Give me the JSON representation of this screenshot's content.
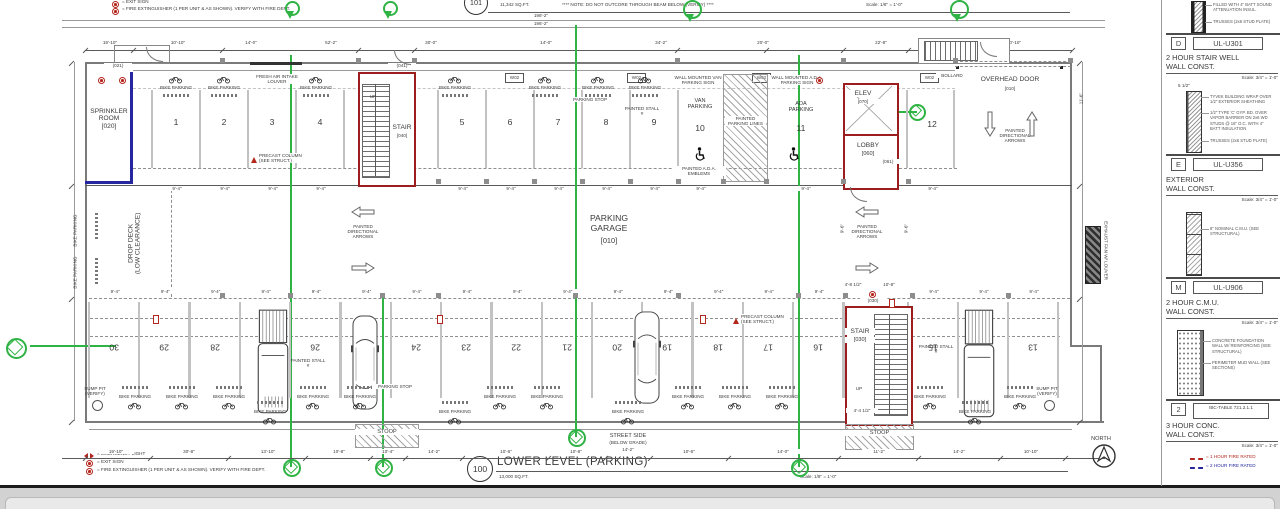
{
  "colors": {
    "green": "#2fb344",
    "red_wall": "#9b1d1d",
    "blue_wall": "#26269e",
    "legend_red": "#b3271e",
    "legend_blue": "#26269e"
  },
  "legend_top": {
    "exit": "= EXIT SIGN",
    "extinguisher": "= FIRE EXTINGUISHER (1 PER UNIT & AS SHOWN). VERIFY WITH FIRE DEPT."
  },
  "legend_bottom": {
    "emergency": "= EMERGENCY LIGHT",
    "exit": "= EXIT SIGN",
    "extinguisher": "= FIRE EXTINGUISHER (1 PER UNIT & AS SHOWN). VERIFY WITH FIRE DEPT."
  },
  "legend_fire": {
    "one_hour": "= 1 HOUR FIRE RATED",
    "two_hour": "= 2 HOUR FIRE RATED"
  },
  "titles": {
    "upper": {
      "number": "101",
      "sqft": "11,342 SQ.FT.",
      "note": "**** NOTE: DO NOT OUTCORE THROUGH BEAM BELOW (VERIFY) ****",
      "scale": "Scale: 1/8\" = 1'-0\""
    },
    "lower": {
      "number": "100",
      "name": "LOWER LEVEL (PARKING)",
      "sqft": "13,000 SQ.FT.",
      "scale": "Scale: 1/8\" = 1'-0\""
    }
  },
  "compass": {
    "north": "NORTH"
  },
  "rooms": {
    "sprinkler": {
      "name": "SPRINKLER ROOM",
      "tag": "[020]"
    },
    "stair_top": {
      "name": "STAIR",
      "tag": "[040]"
    },
    "stair_bottom": {
      "name": "STAIR",
      "tag": "[030]"
    },
    "elevator": {
      "name": "ELEV",
      "tag": "[070]"
    },
    "lobby": {
      "name": "LOBBY",
      "tag": "[060]"
    },
    "garage": {
      "line1": "PARKING",
      "line2": "GARAGE",
      "tag": "[010]"
    },
    "overhead_door": {
      "name": "OVERHEAD DOOR",
      "tag": "[010]"
    },
    "drop_deck": {
      "line1": "DROP DECK",
      "line2": "(LOW CLEARANCE)"
    },
    "van": {
      "line1": "VAN",
      "line2": "PARKING",
      "number": "10"
    },
    "ada": {
      "line1": "ADA",
      "line2": "PARKING",
      "number": "11"
    }
  },
  "annotations": {
    "bike_parking": "BIKE PARKING",
    "parking_stop": "PARKING STOP",
    "painted_stall": "PAINTED STALL #",
    "fresh_air": "FRESH AIR INTAKE LOUVER",
    "precast": "PRECAST COLUMN (SEE STRUCT.)",
    "van_sign": "WALL MOUNTED VAN PARKING SIGN",
    "ada_sign": "WALL MOUNTED A.D.A. PARKING SIGN",
    "ada_emblem": "PAINTED A.D.A. EMBLEMS",
    "painted_lines": "PAINTED PARKING LINES",
    "directional": "PAINTED DIRECTIONAL ARROWS",
    "sump_pit": "SUMP PIT (VERIFY)",
    "stoop": "STOOP",
    "street_side": "STREET SIDE",
    "below_grade": "(BELOW GRADE)",
    "exhaust_fan": "EXHAUST FAN W/ LOUVER",
    "bollard": "BOLLARD",
    "up": "UP",
    "w02": "W02",
    "door_tags": {
      "sprinkler": "(021)",
      "stair_top": "(041)",
      "lobby": "(061)",
      "stair_bottom": "(030)"
    }
  },
  "stalls": {
    "top_a": [
      "1",
      "2",
      "3",
      "4"
    ],
    "top_b": [
      "5",
      "6",
      "7",
      "8",
      "9"
    ],
    "top_last": "12",
    "bottom_main": [
      "30",
      "29",
      "28",
      "27",
      "26",
      "25",
      "24",
      "23",
      "22",
      "21",
      "20",
      "19",
      "18",
      "17",
      "16"
    ],
    "bottom_right": [
      "15",
      "14",
      "13"
    ]
  },
  "dimensions": {
    "overall": [
      "198'-2\"",
      "196'-2\""
    ],
    "top_row": [
      "19'-10\"",
      "10'-10\"",
      "14'-0\"",
      "52'-2\"",
      "30'-0\"",
      "14'-0\"",
      "34'-2\"",
      "20'-0\"",
      "22'-8\"",
      "10'-10\""
    ],
    "bottom_row": [
      "19'-10\"",
      "30'-8\"",
      "13'-10\"",
      "10'-8\"",
      "10'-4\"",
      "14'-2\"",
      "10'-6\"",
      "10'-8\"",
      "10'-6\"",
      "14'-0\"",
      "11'-2\"",
      "14'-2\"",
      "10'-10\""
    ],
    "stall_width": "9'-4\"",
    "misc": [
      "4'-8 1/2\"",
      "10'-8\"",
      "9'-6\"",
      "11'-6\"",
      "4'-4 1/2\"",
      "14'-2\""
    ]
  },
  "details_panel": [
    {
      "tag": "D",
      "code": "UL-U301",
      "title1": "2 HOUR STAIR WELL",
      "title2": "WALL CONST.",
      "scale": "Scale: 3/4\" = 1'-0\"",
      "notes": [
        "FILLED WITH 4\" BATT SOUND ATTENUATION INSUL.",
        "TRUSSES (2x6 STUD PLATE)"
      ]
    },
    {
      "tag": "E",
      "code": "UL-U356",
      "title1": "EXTERIOR",
      "title2": "WALL CONST.",
      "scale": "Scale: 3/4\" = 1'-0\"",
      "dim": "5 1/2\"",
      "notes": [
        "TYVEK BUILDING WRAP OVER 1/2\" EXTERIOR SHEATHING",
        "1/2\" TYPE 'C' GYP. BD. OVER VAPOR BARRIER ON 2x6 WD STUDS @ 16\" O.C. WITH 4\" BATT INSULATION",
        "TRUSSES (2x6 STUD PLATE)"
      ]
    },
    {
      "tag": "M",
      "code": "UL-U906",
      "title1": "2 HOUR C.M.U.",
      "title2": "WALL CONST.",
      "scale": "Scale: 3/4\" = 1'-0\"",
      "notes": [
        "8\" NOMINAL C.M.U. (SEE STRUCTURAL)"
      ]
    },
    {
      "tag": "2",
      "code": "IBC-TABLE 721.2.1.1",
      "title1": "3 HOUR CONC.",
      "title2": "WALL CONST.",
      "scale": "Scale: 3/4\" = 1'-0\"",
      "notes": [
        "CONCRETE FOUNDATION WALL W/ REINFORCING (SEE STRUCTURAL)",
        "PERIMETER MUD WALL (SEE SECTIONS)"
      ]
    }
  ]
}
